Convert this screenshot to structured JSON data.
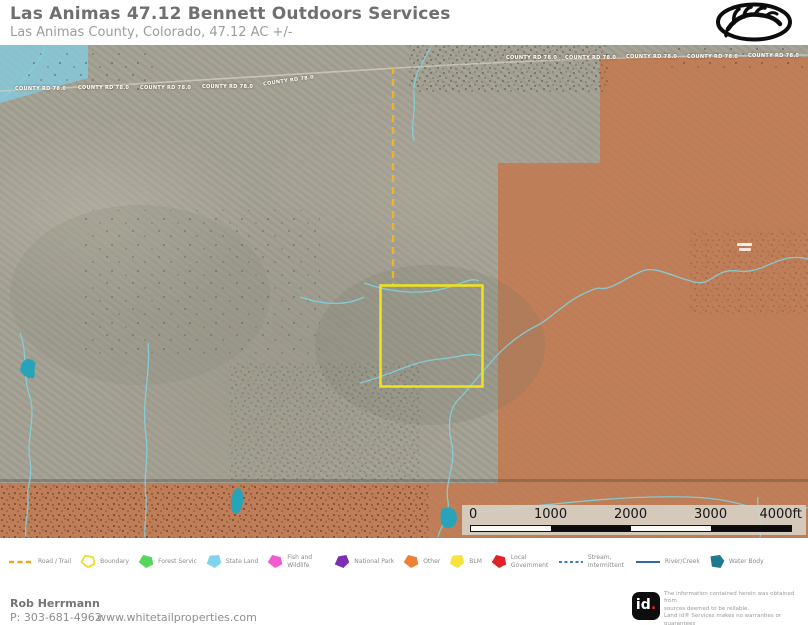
{
  "header": {
    "title": "Las Animas 47.12 Bennett Outdoors Services",
    "subtitle": "Las Animas County, Colorado, 47.12 AC +/-"
  },
  "map": {
    "county_road_label": "COUNTY RD 78.0",
    "colors": {
      "blm_overlay": "#c4764a",
      "state_land_overlay": "#85cade",
      "boundary_yellow": "#ece21d",
      "road_trail_dash": "#f2b31c",
      "stream": "#82d2de",
      "water_body": "#27a4ba"
    }
  },
  "scale_bar": {
    "tick0": "0",
    "tick1": "1000",
    "tick2": "2000",
    "tick3": "3000",
    "end": "4000ft"
  },
  "legend": {
    "items": [
      {
        "label": "Road / Trail",
        "color": "#f0a51f"
      },
      {
        "label": "Boundary",
        "color": "#ffffff",
        "stroke": "#e8de2a"
      },
      {
        "label": "Forest Servic",
        "color": "#57d65c"
      },
      {
        "label": "State Land",
        "color": "#7fd3ec"
      },
      {
        "label": "Fish and Wildlife",
        "color": "#f25ad1"
      },
      {
        "label": "National Park",
        "color": "#7b2fb4"
      },
      {
        "label": "Other",
        "color": "#ef8038"
      },
      {
        "label": "BLM",
        "color": "#f6e33f"
      },
      {
        "label": "Local Government",
        "color": "#e32228"
      },
      {
        "label": "Stream, Intermittent",
        "color": "#3a7bc8"
      },
      {
        "label": "River/Creek",
        "color": "#2d6e9e"
      },
      {
        "label": "Water Body",
        "color": "#20798f"
      }
    ]
  },
  "footer": {
    "agent_name": "Rob Herrmann",
    "phone": "P: 303-681-4962",
    "website": "www.whitetailproperties.com",
    "brand_id": "id",
    "brand_dot": ".",
    "disclaimer_line1": "The information contained herein was obtained from",
    "disclaimer_line2": "sources deemed to be reliable.",
    "disclaimer_line3": "Land id® Services makes no warranties or guarantees",
    "disclaimer_line4": "as to the completeness or accuracy thereof."
  }
}
